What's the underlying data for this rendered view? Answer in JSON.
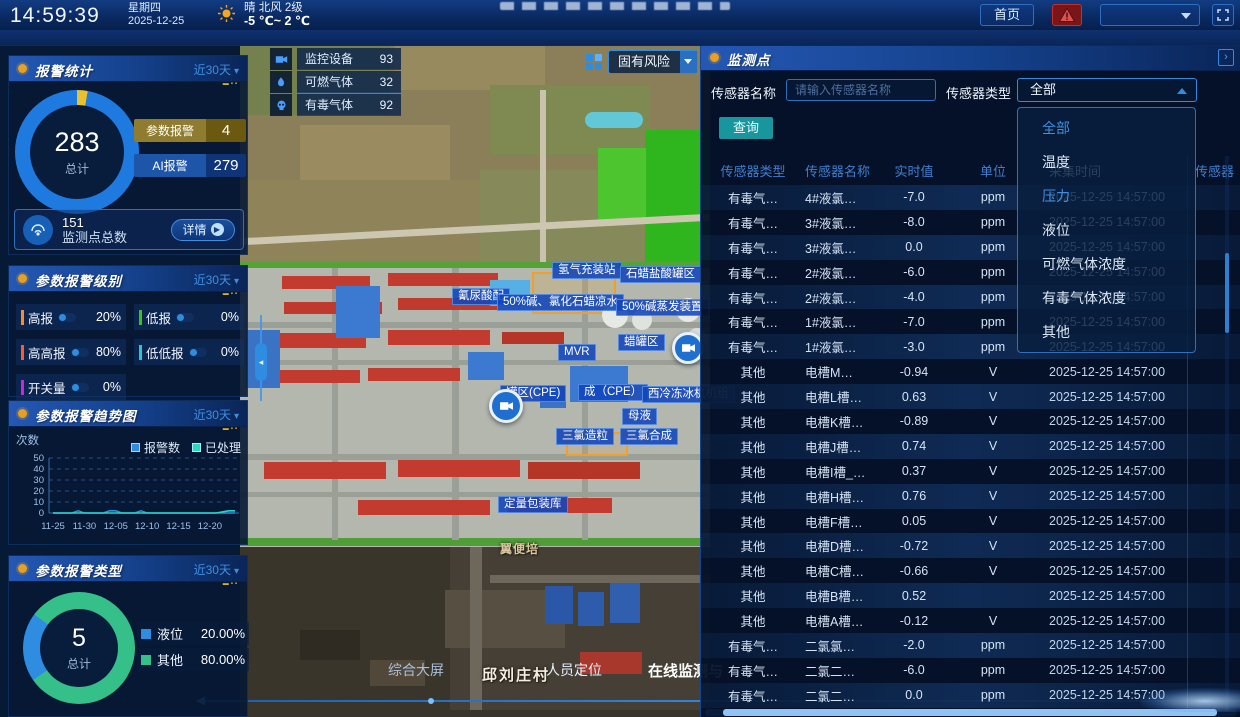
{
  "topbar": {
    "time": "14:59:39",
    "weekday": "星期四",
    "date": "2025-12-25",
    "weather": {
      "icon": "sun-icon",
      "condition": "晴 北风 2级",
      "temperature": "-5 ℃~ 2 ℃"
    },
    "home_button": "首页",
    "header_select_value": ""
  },
  "left_panels": {
    "alarm_stats": {
      "title": "报警统计",
      "range": "近30天",
      "donut": {
        "total": "283",
        "total_label": "总计"
      },
      "stats": [
        {
          "label": "参数报警",
          "value": "4",
          "label_color": "#8f7c2e",
          "value_color": "#6b590f"
        },
        {
          "label": "AI报警",
          "value": "279",
          "label_color": "#1d55a8",
          "value_color": "#0f3578"
        }
      ],
      "footer": {
        "count": "151",
        "label": "监测点总数",
        "detail_button": "详情"
      }
    },
    "alarm_levels": {
      "title": "参数报警级别",
      "range": "近30天",
      "items": [
        {
          "label": "高报",
          "value": "20%",
          "color": "#ff8a2a"
        },
        {
          "label": "低报",
          "value": "0%",
          "color": "#35c41a"
        },
        {
          "label": "高高报",
          "value": "80%",
          "color": "#ff5a2a"
        },
        {
          "label": "低低报",
          "value": "0%",
          "color": "#22c8d8"
        },
        {
          "label": "开关量",
          "value": "0%",
          "color": "#c42ad8"
        }
      ]
    },
    "alarm_trend": {
      "title": "参数报警趋势图",
      "range": "近30天",
      "ylabel": "次数",
      "legend": [
        {
          "label": "报警数",
          "color": "#2e8de0"
        },
        {
          "label": "已处理",
          "color": "#25d8c8"
        }
      ]
    },
    "alarm_types": {
      "title": "参数报警类型",
      "range": "近30天",
      "donut": {
        "total": "5",
        "total_label": "总计"
      },
      "legend": [
        {
          "label": "液位",
          "value": "20.00%",
          "color": "#2e8de0",
          "pct": 20
        },
        {
          "label": "其他",
          "value": "80.00%",
          "color": "#35c08a",
          "pct": 80
        }
      ]
    }
  },
  "map": {
    "counters": [
      {
        "icon": "camera-icon",
        "label": "监控设备",
        "value": "93"
      },
      {
        "icon": "flame-icon",
        "label": "可燃气体",
        "value": "32"
      },
      {
        "icon": "skull-icon",
        "label": "有毒气体",
        "value": "92"
      }
    ],
    "risk_select": {
      "value": "固有风险",
      "icon": "grid-icon"
    },
    "labels": [
      {
        "text": "氢气充装站",
        "x": 552,
        "y": 262
      },
      {
        "text": "石蜡盐酸罐区",
        "x": 620,
        "y": 266
      },
      {
        "text": "氰尿酸配",
        "x": 452,
        "y": 288
      },
      {
        "text": "50%碱、氯化石蜡凉水",
        "x": 497,
        "y": 294
      },
      {
        "text": "50%碱蒸发装置",
        "x": 616,
        "y": 299
      },
      {
        "text": "MVR",
        "x": 558,
        "y": 344
      },
      {
        "text": "蜡罐区",
        "x": 618,
        "y": 334
      },
      {
        "text": "罐区(CPE)",
        "x": 500,
        "y": 385
      },
      {
        "text": "成（CPE）",
        "x": 578,
        "y": 384
      },
      {
        "text": "西冷冻冰机机组",
        "x": 642,
        "y": 386
      },
      {
        "text": "母液",
        "x": 622,
        "y": 408
      },
      {
        "text": "三氯造粒",
        "x": 556,
        "y": 428
      },
      {
        "text": "三氯合成",
        "x": 620,
        "y": 428
      },
      {
        "text": "定量包装库",
        "x": 498,
        "y": 496
      }
    ],
    "place_labels": [
      {
        "text": "邱刘庄村",
        "x": 482,
        "y": 664,
        "style": "village"
      },
      {
        "text": "翼便培",
        "x": 500,
        "y": 540,
        "style": "small"
      }
    ],
    "bottom_nav": [
      "综合大屏",
      "人员定位",
      "在线监测与"
    ]
  },
  "monitor": {
    "title": "监测点",
    "filters": {
      "name_label": "传感器名称",
      "name_placeholder": "请输入传感器名称",
      "type_label": "传感器类型",
      "type_value": "全部",
      "query_button": "查询"
    },
    "dropdown": {
      "options": [
        "全部",
        "温度",
        "压力",
        "液位",
        "可燃气体浓度",
        "有毒气体浓度",
        "其他"
      ],
      "selected_index": 0,
      "highlight_index": 2
    },
    "table": {
      "headers": [
        "传感器类型",
        "传感器名称",
        "实时值",
        "单位",
        "采集时间"
      ],
      "overflow_header": "传感器",
      "rows": [
        [
          "有毒气…",
          "4#液氯…",
          "-7.0",
          "ppm",
          "2025-12-25 14:57:00"
        ],
        [
          "有毒气…",
          "3#液氯…",
          "-8.0",
          "ppm",
          "2025-12-25 14:57:00"
        ],
        [
          "有毒气…",
          "3#液氯…",
          "0.0",
          "ppm",
          "2025-12-25 14:57:00"
        ],
        [
          "有毒气…",
          "2#液氯…",
          "-6.0",
          "ppm",
          "2025-12-25 14:57:00"
        ],
        [
          "有毒气…",
          "2#液氯…",
          "-4.0",
          "ppm",
          "2025-12-25 14:57:00"
        ],
        [
          "有毒气…",
          "1#液氯…",
          "-7.0",
          "ppm",
          "2025-12-25 14:57:00"
        ],
        [
          "有毒气…",
          "1#液氯…",
          "-3.0",
          "ppm",
          "2025-12-25 14:57:00"
        ],
        [
          "其他",
          "电槽M…",
          "-0.94",
          "V",
          "2025-12-25 14:57:00"
        ],
        [
          "其他",
          "电槽L槽…",
          "0.63",
          "V",
          "2025-12-25 14:57:00"
        ],
        [
          "其他",
          "电槽K槽…",
          "-0.89",
          "V",
          "2025-12-25 14:57:00"
        ],
        [
          "其他",
          "电槽J槽…",
          "0.74",
          "V",
          "2025-12-25 14:57:00"
        ],
        [
          "其他",
          "电槽I槽_…",
          "0.37",
          "V",
          "2025-12-25 14:57:00"
        ],
        [
          "其他",
          "电槽H槽…",
          "0.76",
          "V",
          "2025-12-25 14:57:00"
        ],
        [
          "其他",
          "电槽F槽…",
          "0.05",
          "V",
          "2025-12-25 14:57:00"
        ],
        [
          "其他",
          "电槽D槽…",
          "-0.72",
          "V",
          "2025-12-25 14:57:00"
        ],
        [
          "其他",
          "电槽C槽…",
          "-0.66",
          "V",
          "2025-12-25 14:57:00"
        ],
        [
          "其他",
          "电槽B槽…",
          "0.52",
          "",
          "2025-12-25 14:57:00"
        ],
        [
          "其他",
          "电槽A槽…",
          "-0.12",
          "V",
          "2025-12-25 14:57:00"
        ],
        [
          "有毒气…",
          "二氯氯…",
          "-2.0",
          "ppm",
          "2025-12-25 14:57:00"
        ],
        [
          "有毒气…",
          "二氯二…",
          "-6.0",
          "ppm",
          "2025-12-25 14:57:00"
        ],
        [
          "有毒气…",
          "二氯二…",
          "0.0",
          "ppm",
          "2025-12-25 14:57:00"
        ]
      ]
    }
  },
  "chart_data": [
    {
      "type": "line",
      "title": "参数报警趋势图",
      "ylabel": "次数",
      "xlabel": "",
      "ylim": [
        0,
        50
      ],
      "grid": true,
      "legend_position": "top-right",
      "x_ticks": [
        "11-25",
        "11-30",
        "12-05",
        "12-10",
        "12-15",
        "12-20"
      ],
      "n_points": 30,
      "series": [
        {
          "name": "报警数",
          "color": "#2e8de0",
          "values": [
            0,
            0,
            0,
            0,
            2,
            0,
            0,
            0,
            0,
            2,
            2,
            0,
            0,
            0,
            2,
            0,
            0,
            0,
            0,
            0,
            0,
            0,
            0,
            0,
            0,
            0,
            0,
            0,
            0,
            0
          ]
        },
        {
          "name": "已处理",
          "color": "#25d8c8",
          "values": [
            0,
            0,
            0,
            0,
            0,
            0,
            0,
            0,
            0,
            0,
            0,
            0,
            0,
            0,
            0,
            0,
            0,
            0,
            0,
            0,
            0,
            0,
            0,
            0,
            0,
            0,
            0,
            1,
            2,
            2
          ]
        }
      ]
    },
    {
      "type": "pie",
      "title": "报警统计",
      "labels": [
        "参数报警",
        "AI报警"
      ],
      "values": [
        4,
        279
      ],
      "colors": [
        "#e8c030",
        "#1f7ae0"
      ],
      "center_total": 283
    },
    {
      "type": "pie",
      "title": "参数报警类型",
      "labels": [
        "液位",
        "其他"
      ],
      "values": [
        20.0,
        80.0
      ],
      "colors": [
        "#2e8de0",
        "#35c08a"
      ],
      "center_total": 5
    }
  ]
}
